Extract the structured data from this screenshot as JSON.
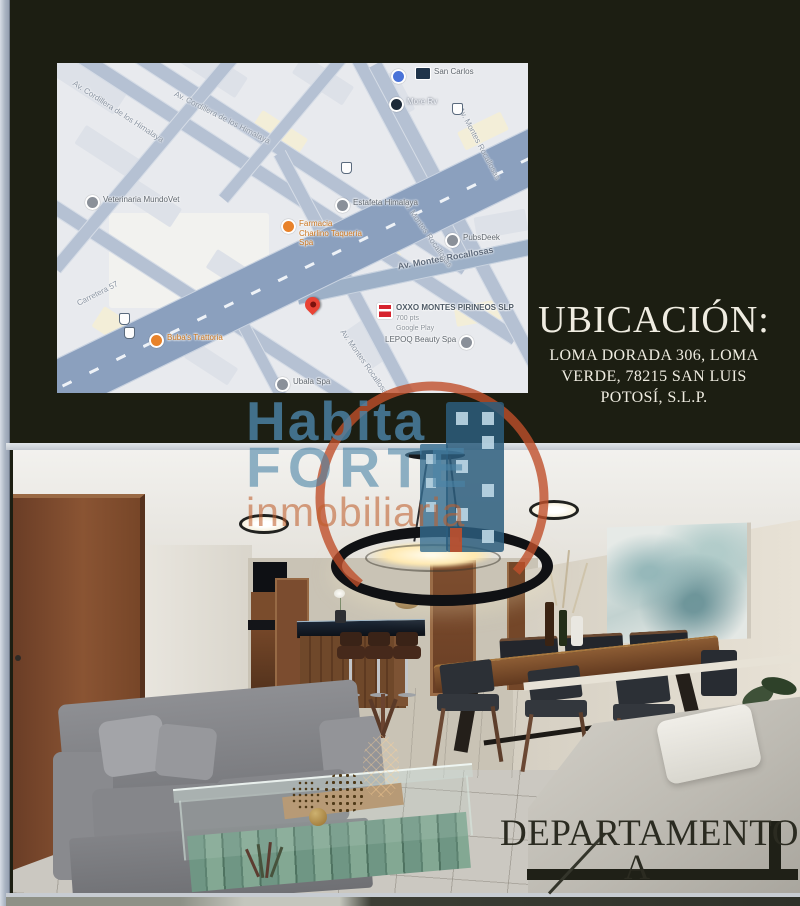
{
  "location": {
    "title": "UBICACIÓN:",
    "address_line1": "LOMA DORADA 306, LOMA",
    "address_line2": "VERDE, 78215 SAN LUIS",
    "address_line3": "POTOSÍ, S.L.P."
  },
  "watermark": {
    "word1": "Habita",
    "word2": "FORTE",
    "word3": "inmobiliaria"
  },
  "apartment": {
    "label": "DEPARTAMENTO",
    "unit": "A"
  },
  "map": {
    "pois": [
      {
        "name": "San Carlos"
      },
      {
        "name": "More Rv"
      },
      {
        "name": "Veterinaria MundoVet"
      },
      {
        "name": "Estafeta Himalaya"
      },
      {
        "name": "Farmacia",
        "line2": "Charlino Taquería",
        "line3": "Spa"
      },
      {
        "name": "PubsDeek"
      },
      {
        "name": "OXXO MONTES PIRINEOS SLP",
        "sub1": "700 pts",
        "sub2": "Google Play"
      },
      {
        "name": "LEPOQ Beauty Spa"
      },
      {
        "name": "Buba's Trattoria"
      },
      {
        "name": "Ubala Spa"
      }
    ],
    "streets": [
      {
        "name": "Av. Cordillera de los Himalaya"
      },
      {
        "name": "Av. Cordillera de los Himalaya"
      },
      {
        "name": "Carretera 57"
      },
      {
        "name": "Av. Montes Rocallosas"
      },
      {
        "name": "Av. Montes Rocallosas"
      },
      {
        "name": "Av. Montes Rocallosas"
      },
      {
        "name": "Av. Montes Rocallosas"
      }
    ]
  },
  "colors": {
    "watermark_blue": "#4a83a6",
    "watermark_orange": "#bf5e2d",
    "pin_red": "#e94335",
    "oxxo_red": "#d6232e",
    "map_highway": "#8ba0be",
    "background_dark": "#1c1e12"
  }
}
